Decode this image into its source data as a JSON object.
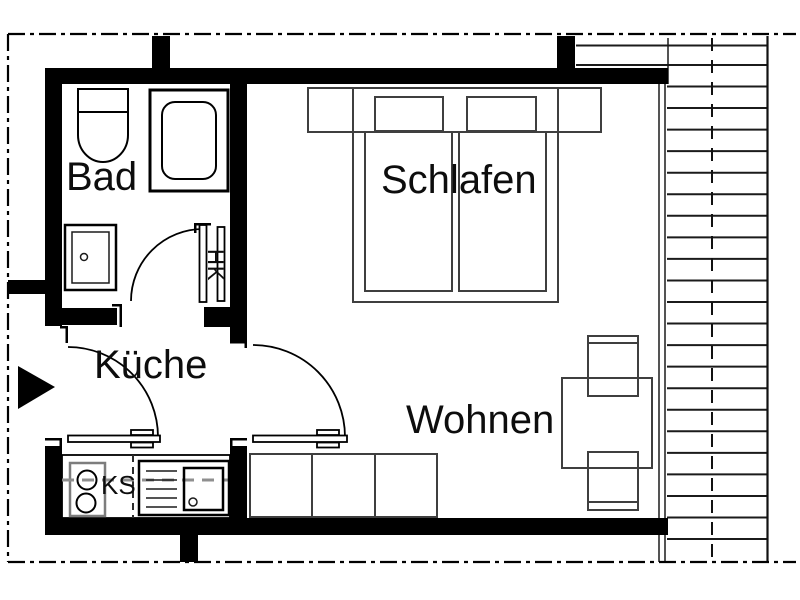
{
  "plan": {
    "rooms": {
      "bathroom": {
        "label": "Bad"
      },
      "bedroom": {
        "label": "Schlafen"
      },
      "kitchen": {
        "label": "Küche"
      },
      "living": {
        "label": "Wohnen"
      }
    },
    "labels": {
      "fridge": "KS",
      "radiator": "HK"
    },
    "colors": {
      "walls": "#000000",
      "furniture": "#3f3f3f",
      "boundary": "#000000",
      "background": "#ffffff"
    }
  }
}
